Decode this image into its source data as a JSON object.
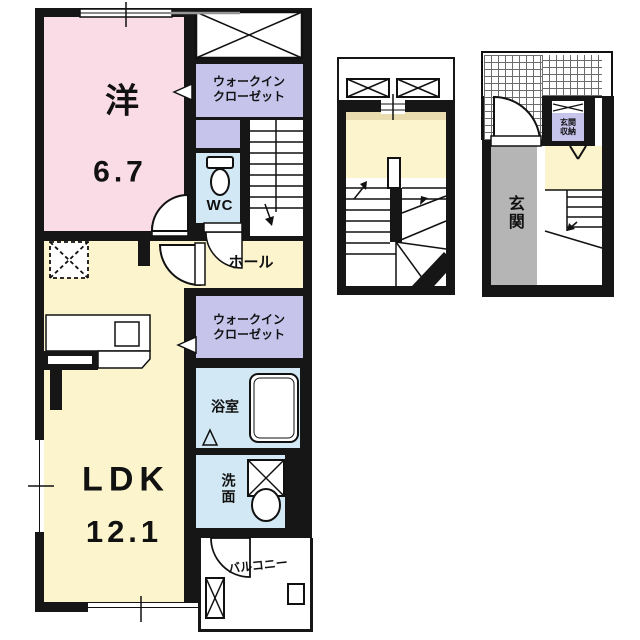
{
  "colors": {
    "wall": "#161616",
    "room_pink": "#fadce6",
    "room_yellow": "#fbf4cd",
    "room_purple": "#c7c4ec",
    "room_blue": "#d2e8f4",
    "genkan_gray": "#b5b5b5",
    "landing_tan": "#e9ddb0",
    "paper": "#ffffff"
  },
  "floor3": {
    "western_room_label": "洋",
    "western_room_size": "6.7",
    "walkin_closet_upper_label": "ウォークイン\nクローゼット",
    "wc_label": "WC",
    "hall_label": "ホール",
    "walkin_closet_lower_label": "ウォークイン\nクローゼット",
    "bathroom_label": "浴室",
    "washroom_label": "洗面",
    "ldk_label": "LDK",
    "ldk_size": "12.1",
    "balcony_label": "バルコニー"
  },
  "floor1": {
    "entrance_label": "玄関",
    "entrance_storage_label": "玄関\n収納"
  }
}
